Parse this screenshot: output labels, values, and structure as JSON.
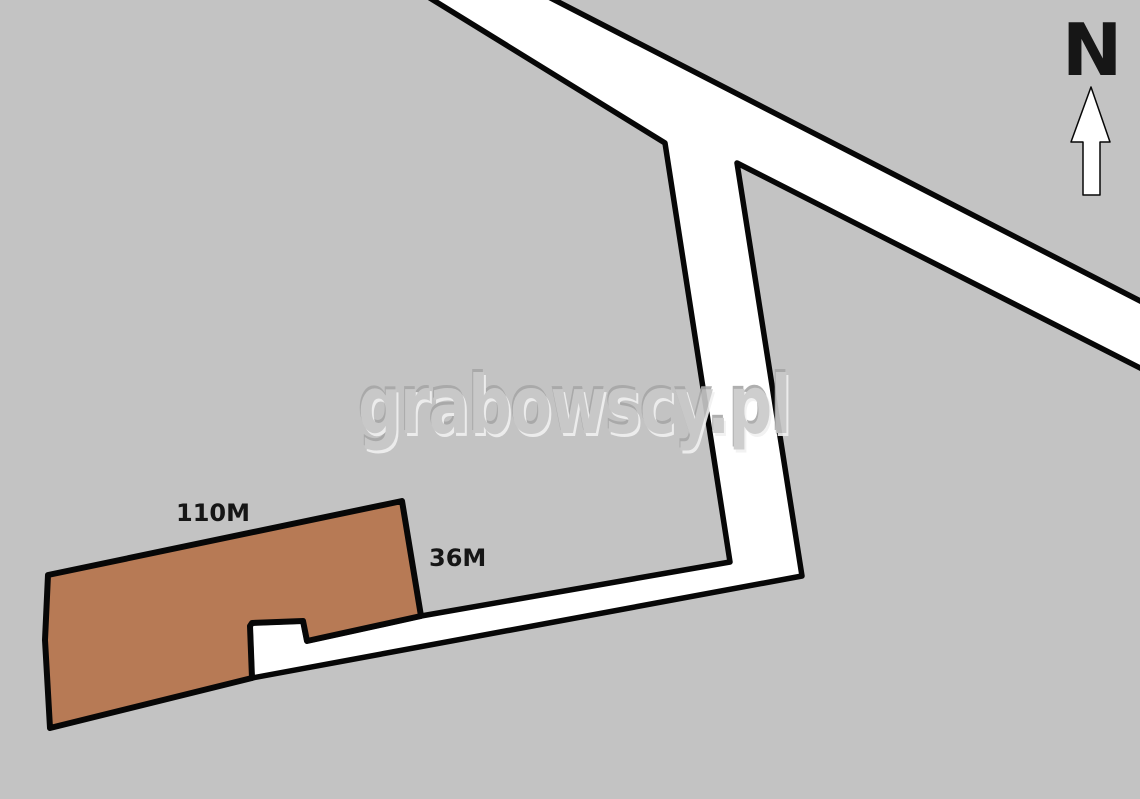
{
  "map": {
    "watermark": "grabowscy.pl",
    "north": {
      "label": "N"
    },
    "parcel": {
      "top_dimension_label": "110M",
      "right_dimension_label": "36M"
    },
    "colors": {
      "background": "#c3c3c3",
      "road_fill": "#ffffff",
      "outline": "#070707",
      "parcel_fill": "#b77a55",
      "label_text": "#161616",
      "north_arrow_fill": "#ffffff",
      "watermark_main": "#c9c9c9",
      "watermark_dark": "#a7a7a7",
      "watermark_light": "#f1f1f1"
    }
  }
}
